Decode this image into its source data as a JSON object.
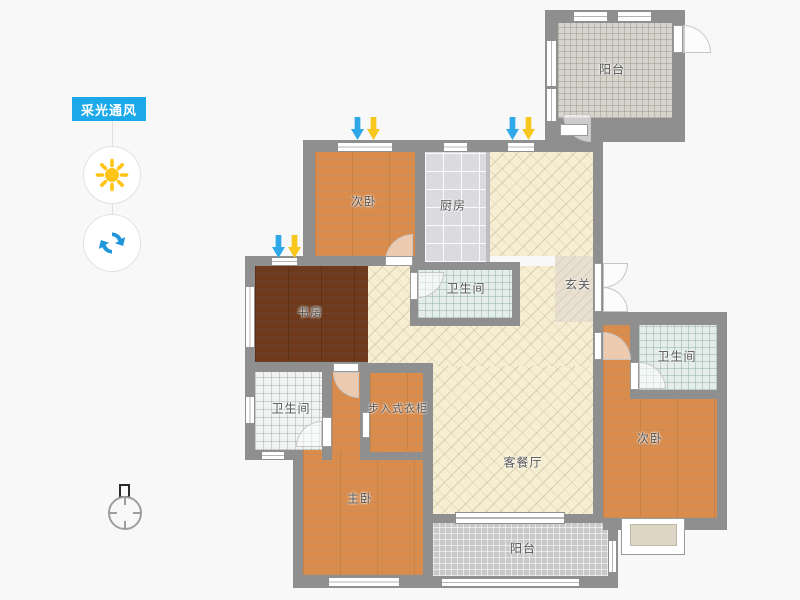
{
  "panel": {
    "tag_label": "采光通风",
    "tag_color": "#1ca9e9",
    "sun_color": "#ffc416",
    "refresh_color": "#1f96dc"
  },
  "rooms": {
    "balcony_top": "阳台",
    "bedroom_top": "次卧",
    "kitchen": "厨房",
    "bathroom_mid": "卫生间",
    "entry": "玄关",
    "study": "书房",
    "bathroom_right": "卫生间",
    "bathroom_left": "卫生间",
    "closet": "步入式衣柜",
    "master": "主卧",
    "living": "客餐厅",
    "bedroom_right": "次卧",
    "balcony_bottom": "阳台"
  },
  "legend": {
    "light_arrow_color": "#f7c71d",
    "wind_arrow_color": "#2fa8e8",
    "wall_color": "#8f8f8f"
  }
}
